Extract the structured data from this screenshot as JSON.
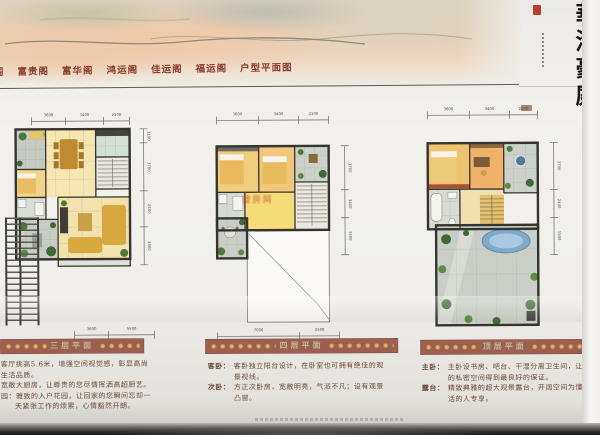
{
  "header": {
    "clipped_pavilion": "阁",
    "pavilions": [
      "富贵阁",
      "富华阁",
      "鸿运阁",
      "佳运阁",
      "福运阁"
    ],
    "page_title": "户型平面图"
  },
  "brand": {
    "calligraphy": "華港豪庭"
  },
  "watermark": "搜房网",
  "plans": [
    {
      "banner": "三层平面",
      "dims_top": [
        "3600",
        "3400",
        "2100"
      ],
      "dims_right": [
        "1100",
        "3700",
        "2400",
        "3300"
      ],
      "dims_bottom": [
        "3600",
        "5500"
      ],
      "desc_lines": [
        "客厅挑高5.6米，增强空间视觉感，彰显高尚",
        "生活品质。",
        "宽敞大厨房，让尊贵的您尽情挥洒高超厨艺。",
        "园：雅致的入户花园，让回家的您瞬间忘却一",
        "天紧张工作的烦累，心情豁然开朗。"
      ]
    },
    {
      "banner": "四层平面",
      "dims_top": [
        "3600",
        "3400",
        "2100"
      ],
      "dims_right": [
        "3700",
        "3400",
        "1500"
      ],
      "dims_bottom": [
        "7000",
        "2100"
      ],
      "desc": [
        {
          "label": "客卧：",
          "text": "客卧独立阳台设计，在卧室也可拥有绝佳的观景视线。"
        },
        {
          "label": "次卧：",
          "text": "方正次卧房，宽敞明亮，气派不凡；设有观景凸窗。"
        }
      ]
    },
    {
      "banner": "顶层平面",
      "dims_top": [
        "3600",
        "3400",
        "2100"
      ],
      "dims_right": [
        "3700",
        "2400",
        "1500"
      ],
      "desc": [
        {
          "label": "主卧：",
          "text": "主卧设书房、吧台、干湿分离卫生间，让主人的私密空间得到最良好的保证。"
        },
        {
          "label": "露台：",
          "text": "精致典雅的超大观景露台，开阔空间为懂得生活的人专享。"
        }
      ]
    }
  ]
}
